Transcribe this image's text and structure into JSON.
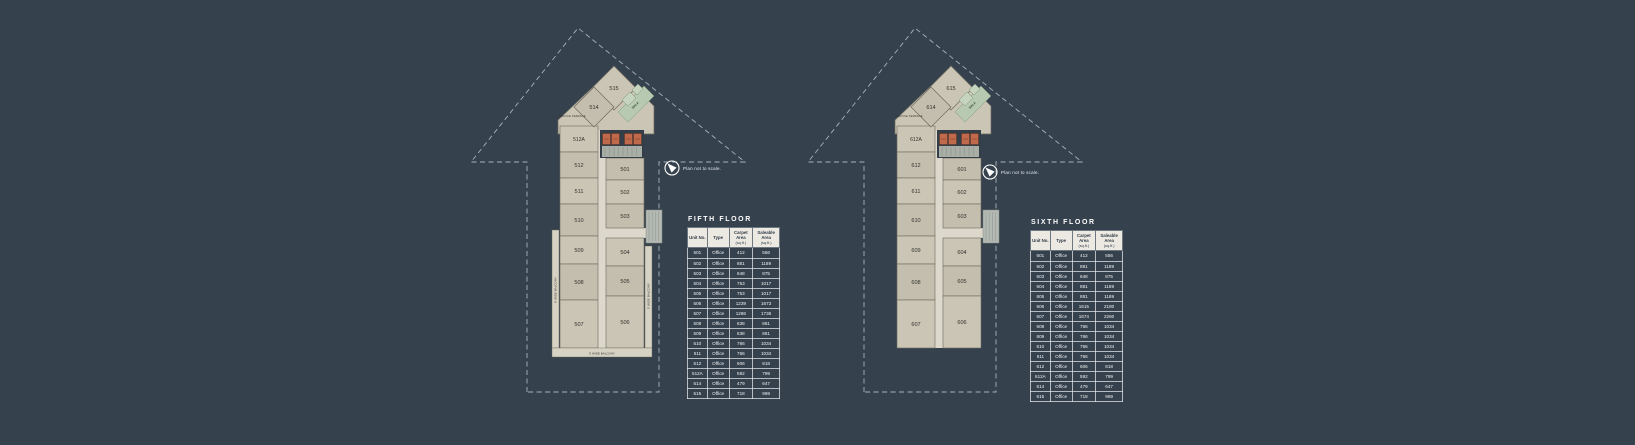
{
  "scale_note": "Plan not to scale.",
  "colors": {
    "background": "#35414d",
    "room": "#cbc5b6",
    "room_alt": "#c4beaf",
    "corridor": "#dcd8cb",
    "balcony": "#d6d2c4",
    "green_walk": "#b7c9b1",
    "green_room": "#c6d4bf",
    "lift_orange": "#c06a4b",
    "dark_core": "#333e49",
    "stair_gray": "#a9aea7",
    "boundary_dash": "#a7b1ba",
    "table_header_bg": "#ece9e2",
    "unit_text": "#32322b"
  },
  "floors": [
    {
      "id": "fifth",
      "title": "FIFTH FLOOR",
      "plan": {
        "top_units": [
          "515",
          "514"
        ],
        "left_units": [
          "512A",
          "512",
          "511",
          "510",
          "509",
          "508",
          "507"
        ],
        "right_units": [
          "501",
          "502",
          "503",
          "504",
          "505",
          "506"
        ],
        "walk_label": "WALK",
        "service_terrace_label": "SERVICE TERRACE",
        "balcony_left": "5' WIDE BALCONY",
        "balcony_right": "5' WIDE BALCONY",
        "balcony_bottom": "5' WIDE BALCONY"
      },
      "table": {
        "headers": [
          {
            "label": "Unit No.",
            "sub": ""
          },
          {
            "label": "Type",
            "sub": ""
          },
          {
            "label": "Carpet Area",
            "sub": "(sq.ft.)"
          },
          {
            "label": "Saleable Area",
            "sub": "(sq.ft.)"
          }
        ],
        "rows": [
          [
            "501",
            "Office",
            "412",
            "556"
          ],
          [
            "502",
            "Office",
            "881",
            "1189"
          ],
          [
            "503",
            "Office",
            "648",
            "875"
          ],
          [
            "504",
            "Office",
            "753",
            "1017"
          ],
          [
            "505",
            "Office",
            "753",
            "1017"
          ],
          [
            "506",
            "Office",
            "1239",
            "1673"
          ],
          [
            "507",
            "Office",
            "1286",
            "1736"
          ],
          [
            "508",
            "Office",
            "638",
            "861"
          ],
          [
            "509",
            "Office",
            "638",
            "861"
          ],
          [
            "510",
            "Office",
            "766",
            "1034"
          ],
          [
            "511",
            "Office",
            "766",
            "1034"
          ],
          [
            "512",
            "Office",
            "606",
            "818"
          ],
          [
            "512A",
            "Office",
            "592",
            "799"
          ],
          [
            "514",
            "Office",
            "479",
            "647"
          ],
          [
            "515",
            "Office",
            "718",
            "969"
          ]
        ]
      }
    },
    {
      "id": "sixth",
      "title": "SIXTH FLOOR",
      "plan": {
        "top_units": [
          "615",
          "614"
        ],
        "left_units": [
          "612A",
          "612",
          "611",
          "610",
          "609",
          "608",
          "607"
        ],
        "right_units": [
          "601",
          "602",
          "603",
          "604",
          "605",
          "606"
        ],
        "walk_label": "WALK",
        "service_terrace_label": "SERVICE TERRACE",
        "balcony_left": null,
        "balcony_right": null,
        "balcony_bottom": null
      },
      "table": {
        "headers": [
          {
            "label": "Unit No.",
            "sub": ""
          },
          {
            "label": "Type",
            "sub": ""
          },
          {
            "label": "Carpet Area",
            "sub": "(sq.ft.)"
          },
          {
            "label": "Saleable Area",
            "sub": "(sq.ft.)"
          }
        ],
        "rows": [
          [
            "601",
            "Office",
            "412",
            "556"
          ],
          [
            "602",
            "Office",
            "881",
            "1189"
          ],
          [
            "603",
            "Office",
            "648",
            "875"
          ],
          [
            "604",
            "Office",
            "881",
            "1189"
          ],
          [
            "605",
            "Office",
            "881",
            "1189"
          ],
          [
            "606",
            "Office",
            "1615",
            "2180"
          ],
          [
            "607",
            "Office",
            "1674",
            "2260"
          ],
          [
            "608",
            "Office",
            "766",
            "1034"
          ],
          [
            "609",
            "Office",
            "766",
            "1034"
          ],
          [
            "610",
            "Office",
            "766",
            "1034"
          ],
          [
            "611",
            "Office",
            "766",
            "1034"
          ],
          [
            "612",
            "Office",
            "606",
            "818"
          ],
          [
            "612A",
            "Office",
            "592",
            "799"
          ],
          [
            "614",
            "Office",
            "479",
            "647"
          ],
          [
            "615",
            "Office",
            "718",
            "969"
          ]
        ]
      }
    }
  ]
}
